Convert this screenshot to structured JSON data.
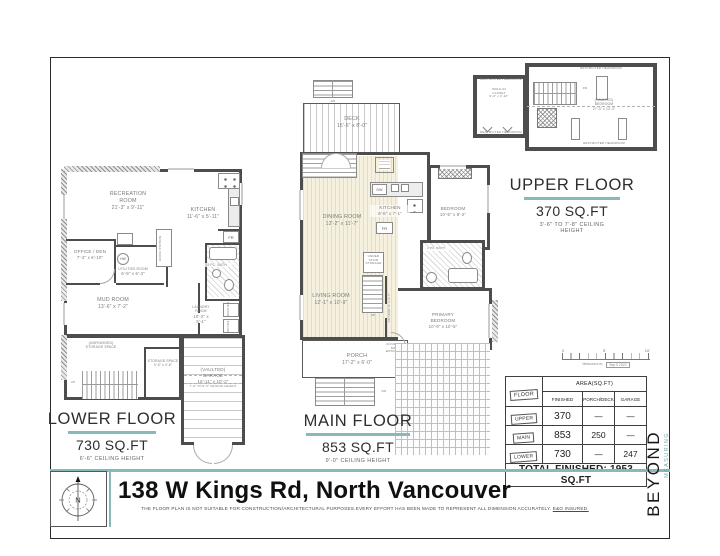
{
  "footer": {
    "address": "138 W Kings Rd, North Vancouver",
    "disclaimer": "THE FLOOR PLAN IS NOT SUITABLE FOR CONSTRUCTION/ARCHITECTURAL PURPOSES.EVERY EFFORT HAS BEEN MADE TO REPRESENT ALL DIMENSION ACCURATELY. ",
    "disclaimer_underlined": "E&O INSURED.",
    "compass_label": "N"
  },
  "brand": {
    "name": "BEYOND",
    "tagline": "MEASURING"
  },
  "floors": {
    "lower": {
      "title": "LOWER FLOOR",
      "area": "730 SQ.FT",
      "ceiling": "6'-6\" CEILING HEIGHT",
      "rooms": {
        "recreation": {
          "name": "RECREATION ROOM",
          "dim": "21'-3\" x 9'-11\""
        },
        "kitchen": {
          "name": "KITCHEN",
          "dim": "11'-6\" x 5'-11\""
        },
        "office": {
          "name": "OFFICE / DEN",
          "dim": "7'-2\" x 6'-10\""
        },
        "hw": "HW",
        "utilities": {
          "name": "UTILITIES ROOM",
          "dim": "6'-9\" x 6'-3\""
        },
        "workstation": "WORK STATION",
        "bath": "4 PC. BATH",
        "mud": {
          "name": "MUD ROOM",
          "dim": "13'-6\" x 7'-2\""
        },
        "laundry": {
          "name": "LAUNDRY ROOM",
          "dim": "10'-2\" x 5'-1\""
        },
        "washer": "WASHER",
        "dryer": "DRYER",
        "fridge": "FR",
        "unfinished": "(UNFINISHED) STORAGE SPACE",
        "storage": {
          "name": "STORAGE SPACE",
          "dim": "9'-5\" x 4'-8\""
        },
        "garage": {
          "name": "(VAULTED) GARAGE",
          "dim": "16'-11\" x 10'-2\"",
          "note": "7'-0\" TO 9'-2\" CEILING HEIGHT"
        },
        "up": "UP"
      }
    },
    "main": {
      "title": "MAIN FLOOR",
      "area": "853 SQ.FT",
      "ceiling": "9'-0\" CEILING HEIGHT",
      "rooms": {
        "deck": {
          "name": "DECK",
          "dim": "15'-6\" x 8'-0\""
        },
        "dining": {
          "name": "DINING ROOM",
          "dim": "12'-2\" x 11'-7\""
        },
        "kitchen": {
          "name": "KITCHEN",
          "dim": "8'-6\" x 7'-1\""
        },
        "dw": "DW",
        "fridge": "FR",
        "bedroom": {
          "name": "BEDROOM",
          "dim": "10'-5\" x 8'-2\""
        },
        "bath": "4 PC. BATH",
        "understair": "UNDER STAIR STORAGE",
        "living": {
          "name": "LIVING ROOM",
          "dim": "12'-1\" x 10'-9\""
        },
        "foyer": {
          "name": "FOYER",
          "dim": "8'-5\" x 3'-7\""
        },
        "primary": {
          "name": "PRIMARY BEDROOM",
          "dim": "10'-9\" x 10'-5\""
        },
        "entrance": "(COVERED) MAIN ENTRANCE",
        "porch": {
          "name": "PORCH",
          "dim": "17'-2\" x 6'-0\""
        },
        "dn": "DN",
        "up": "UP"
      }
    },
    "upper": {
      "title": "UPPER FLOOR",
      "area": "370 SQ.FT",
      "ceiling": "3'-6\" TO 7'-8\" CEILING HEIGHT",
      "rooms": {
        "restricted": "RESTRICTED HEADROOM",
        "closet": {
          "name": "WALK-IN CLOSET",
          "dim": "9'-0\" x 3'-10\""
        },
        "bedroom": {
          "name": "(VAULTED) BEDROOM",
          "dim": "27'-3\" x 13'-3\""
        },
        "dn": "DN"
      }
    }
  },
  "summary_table": {
    "floor_header": "FLOOR",
    "area_header": "AREA(SQ.FT)",
    "columns": {
      "finished": "FINISHED",
      "porch": "PORCH/DECK",
      "garage": "GARAGE"
    },
    "rows": [
      {
        "label": "UPPER",
        "finished": "370",
        "porch": "—",
        "garage": "—"
      },
      {
        "label": "MAIN",
        "finished": "853",
        "porch": "250",
        "garage": "—"
      },
      {
        "label": "LOWER",
        "finished": "730",
        "porch": "—",
        "garage": "247"
      }
    ],
    "total": "TOTAL FINISHED: 1953 SQ.FT"
  },
  "scale_bar": {
    "start": "0",
    "mid": "5'",
    "end": "10'",
    "label": "Measured on:",
    "date": "Sep 5 2023"
  }
}
